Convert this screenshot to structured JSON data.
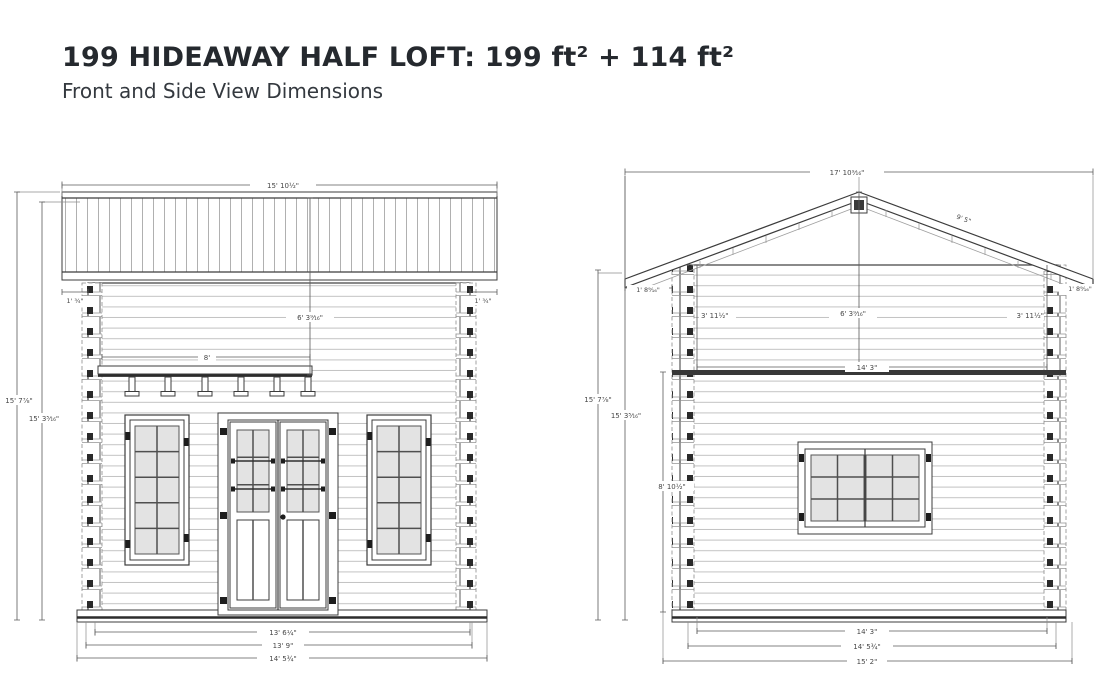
{
  "header": {
    "title": "199 HIDEAWAY HALF LOFT: 199 ft² + 114 ft²",
    "subtitle": "Front and Side View Dimensions"
  },
  "front_view": {
    "dims": {
      "roof_width": "15' 10½\"",
      "eave_left": "1' ¾\"",
      "eave_right": "1' ¾\"",
      "overall_height": "15' 7⅞\"",
      "wall_height": "15' 3⁵⁄₁₆\"",
      "door_height": "6' 3⁹⁄₁₆\"",
      "shelf_width": "8'",
      "inner_width": "13' 6¼\"",
      "wall_width": "13' 9\"",
      "base_width": "14' 5¾\""
    }
  },
  "side_view": {
    "dims": {
      "roof_width": "17' 10⁹⁄₁₆\"",
      "rafter_length": "9' 5\"",
      "eave_left": "1' 8⁹⁄₁₆\"",
      "eave_right": "1' 8⁹⁄₁₆\"",
      "overall_height": "15' 7⅞\"",
      "wall_height": "15' 3⁵⁄₁₆\"",
      "loft_left": "3' 11½\"",
      "loft_center": "6' 3⁹⁄₁₆\"",
      "loft_right": "3' 11½\"",
      "loft_width": "14' 3\"",
      "first_floor_height": "8' 10½\"",
      "floor_width": "14' 3\"",
      "base_width": "14' 5¾\"",
      "overall_width": "15' 2\""
    }
  },
  "colors": {
    "outline": "#3c3c3c",
    "dimension": "#5b5b5b",
    "siding_line": "#c2c2c2",
    "glass": "#e3e3e3",
    "hardware": "#1d1d1d",
    "title_text": "#25292e"
  }
}
